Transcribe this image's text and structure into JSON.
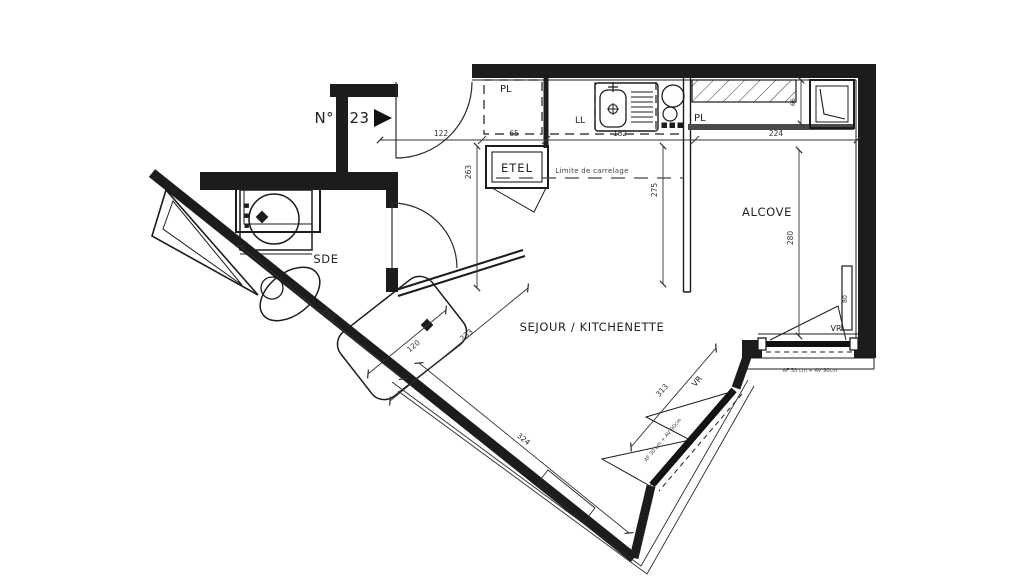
{
  "plan": {
    "unit": "N° 123",
    "rooms": {
      "sde": "SDE",
      "sejour": "SEJOUR / KITCHENETTE",
      "alcove": "ALCOVE"
    },
    "labels": {
      "pl_entry": "PL",
      "pl_alcove": "PL",
      "ll": "LL",
      "etel": "ETEL",
      "vr_alcove": "VR",
      "vr_sejour": "VR"
    },
    "notes": {
      "tile_limit": "Limite de carrelage",
      "alcove_window": "AF 30 cm + AV 90cm",
      "sejour_window": "AF 30 cm + AV 90cm"
    },
    "dims": {
      "entry_width": "122",
      "closet_width": "65",
      "kitchen_width": "182",
      "alcove_width": "224",
      "entry_depth": "263",
      "tile_depth": "275",
      "alcove_depth": "280",
      "shelf_depth": "66",
      "right_window": "80",
      "shower_length": "120",
      "sde_diagonal": "233",
      "sde_wall": "261",
      "sejour_wall": "324",
      "sejour_window": "313"
    },
    "colors": {
      "ink": "#1c1c1c",
      "dim_ink": "#333333",
      "vr": "#7596a5"
    }
  }
}
